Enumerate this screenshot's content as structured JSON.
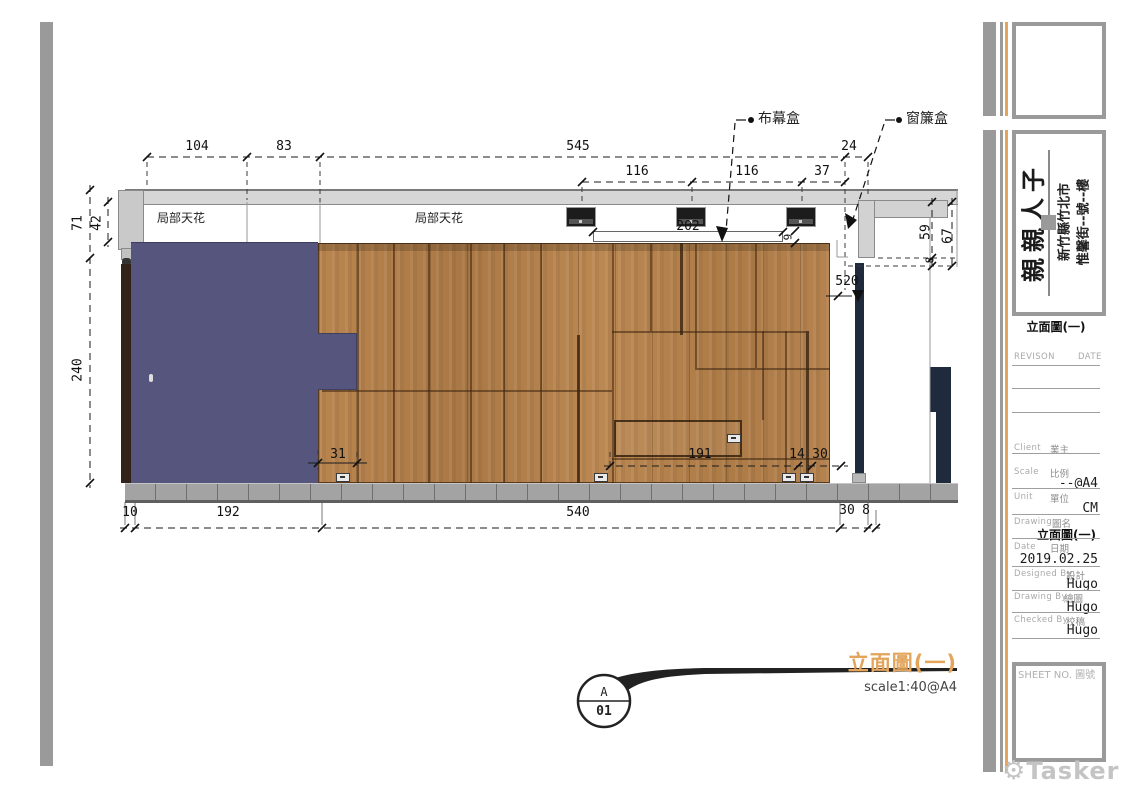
{
  "labels": {
    "partial_ceiling_left": "局部天花",
    "partial_ceiling_right": "局部天花",
    "curtain_screen_box": "布幕盒",
    "curtain_box": "窗簾盒"
  },
  "dims": {
    "d104": "104",
    "d83": "83",
    "d545": "545",
    "d24": "24",
    "d116a": "116",
    "d116b": "116",
    "d37": "37",
    "d202": "202",
    "d9": "9",
    "d71": "71",
    "d42": "42",
    "d240": "240",
    "d59": "59",
    "d67": "67",
    "d8r": "8",
    "d520": "520",
    "d31": "31",
    "d191": "191",
    "d14": "14",
    "d30m": "30",
    "d10": "10",
    "d192": "192",
    "d540": "540",
    "d30b": "30",
    "d8b": "8"
  },
  "drawing_title": {
    "text": "立面圖(一)",
    "scale": "scale1:40@A4",
    "bubble_top": "A",
    "bubble_bottom": "01"
  },
  "title_block": {
    "project": "親親人子",
    "address_line1": "新竹縣竹北市",
    "address_line2": "惟馨街--號--樓",
    "sheet_label": "立面圖(一)",
    "revision_header": "REVISON",
    "date_header": "DATE",
    "client_en": "Client",
    "client_zh": "業主",
    "scale_en": "Scale",
    "scale_zh": "比例",
    "scale_value": "--@A4",
    "unit_en": "Unit",
    "unit_zh": "單位",
    "unit_value": "CM",
    "drawing_en": "Drawing",
    "drawing_zh": "圖名",
    "drawing_value": "立面圖(一)",
    "date_en": "Date",
    "date_zh": "日期",
    "date_value": "2019.02.25",
    "designed_en": "Designed By",
    "designed_zh": "設計",
    "designed_value": "Hugo",
    "drawn_en": "Drawing By",
    "drawn_zh": "繪圖",
    "drawn_value": "Hugo",
    "checked_en": "Checked By",
    "checked_zh": "校稿",
    "checked_value": "Hugo",
    "sheet_no_label": "SHEET NO. 圖號"
  },
  "watermark": {
    "gear_icon": "⚙",
    "text": "Tasker"
  },
  "colors": {
    "accent_orange": "#e3a45b",
    "bar_gray": "#9a9a9a",
    "panel_blue": "#56557d",
    "wood": "#b5824f",
    "ceiling_gray": "#d6d6d6",
    "baseboard_gray": "#a3a3a3",
    "post_navy": "#1f2a3d"
  }
}
